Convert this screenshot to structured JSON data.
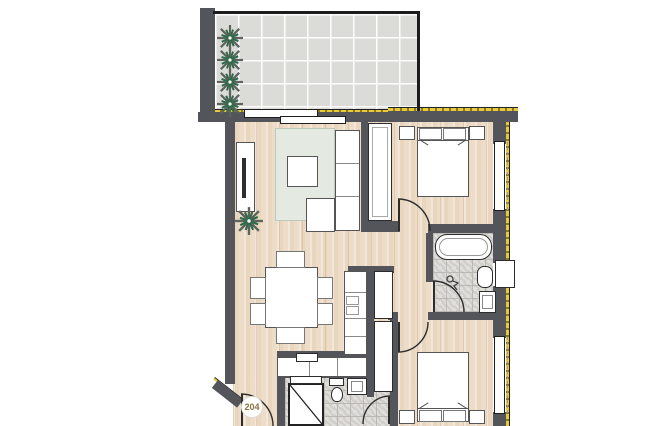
{
  "floor_plan": {
    "unit_label": "204",
    "colors": {
      "wall": "#54555a",
      "wood_floor": "#ecdcc8",
      "terrace_tile": "#dbdbd7",
      "bath_tile": "#d7d5d1",
      "insulation": "#e7c93b",
      "rug": "#e4eae1",
      "plant_green": "#2f6b4a",
      "plant_grey": "#5c645e",
      "furniture_fill": "#ffffff",
      "label_text": "#8a7240"
    },
    "rooms": [
      "terrace",
      "living-room",
      "dining-area",
      "kitchen",
      "hallway",
      "bedroom-1",
      "bathroom",
      "bedroom-2",
      "wc",
      "entry"
    ],
    "elements": {
      "plant-icon": "spiky starburst leaves",
      "bathtub-icon": "rounded rectangle",
      "toilet-icon": "tank + bowl",
      "sink-icon": "framed basin square",
      "shower-icon": "rectangle with diagonal glass line",
      "bed-icon": "blanket with two pillows and nightstands",
      "wardrobe-icon": "tall white cabinet",
      "sofa-icon": "L-shaped sectional with chaise",
      "dining-table-icon": "rectangle table with six chairs",
      "tv-icon": "thin screen bar on sideboard",
      "door-icon": "quarter-circle swing arc",
      "window-icon": "white frame with outer dashed line",
      "drain-icon": "circle with zigzag hose"
    }
  }
}
